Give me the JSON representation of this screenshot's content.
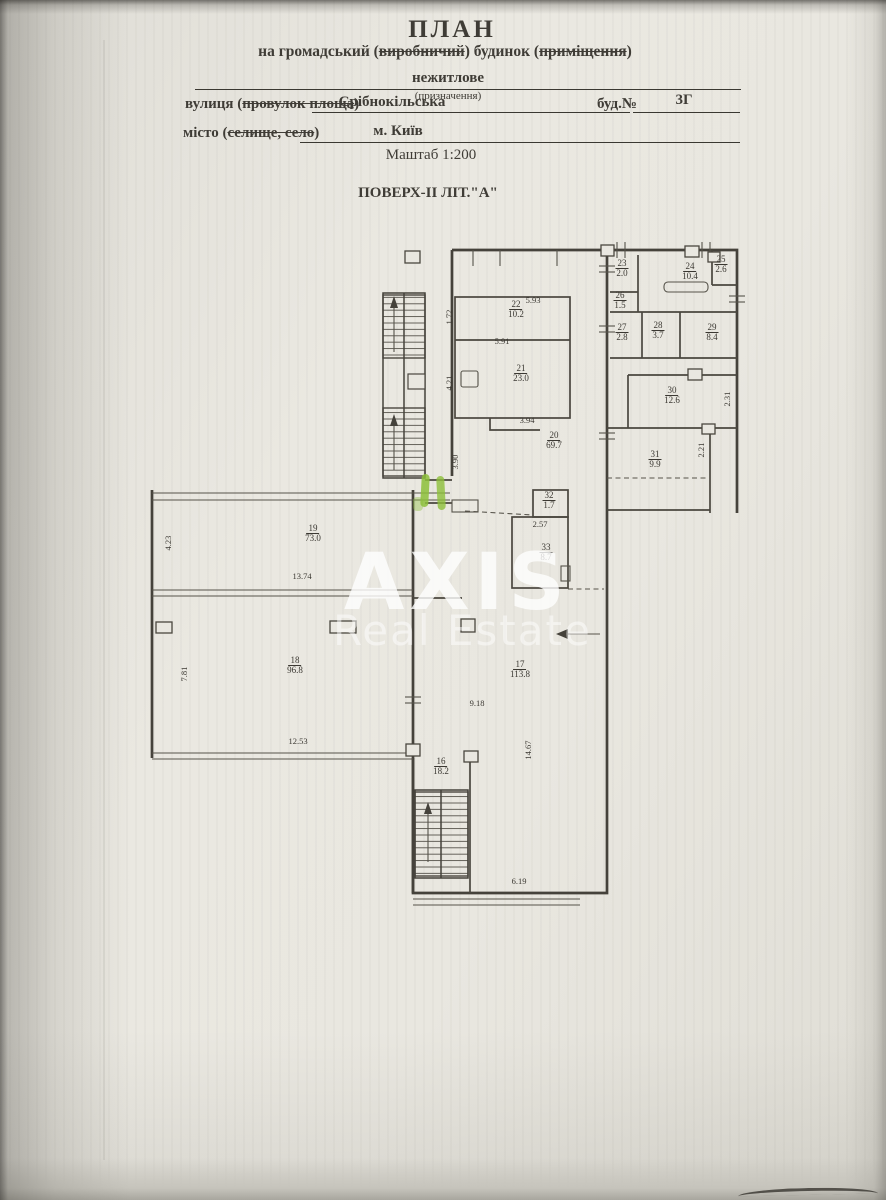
{
  "header": {
    "title": "ПЛАН",
    "subtitle_prefix": "на громадський (",
    "subtitle_struck1": "виробничий",
    "subtitle_mid": ") будинок (",
    "subtitle_struck2": "приміщення",
    "subtitle_suffix": ")",
    "purpose_value": "нежитлове",
    "purpose_caption": "(призначення)",
    "street_prefix": "вулиця (",
    "street_struck": "провулок площа",
    "street_suffix": ")",
    "street_value": "Срібнокільська",
    "building_label": "буд.№",
    "building_value": "3Г",
    "city_prefix": "місто (",
    "city_struck": "селище, село",
    "city_suffix": ")",
    "city_value": "м. Київ",
    "scale": "Маштаб 1:200",
    "floor_title": "ПОВЕРХ-II ЛІТ.\"А\""
  },
  "watermark": {
    "line1": "AXIS",
    "line2": "Real Estate"
  },
  "plan": {
    "rooms": {
      "r16": {
        "number": "16",
        "area": "18.2"
      },
      "r17": {
        "number": "17",
        "area": "113.8"
      },
      "r18": {
        "number": "18",
        "area": "96.8"
      },
      "r19": {
        "number": "19",
        "area": "73.0"
      },
      "r20": {
        "number": "20",
        "area": "69.7"
      },
      "r21": {
        "number": "21",
        "area": "23.0"
      },
      "r22": {
        "number": "22",
        "area": "10.2"
      },
      "r23": {
        "number": "23",
        "area": "2.0"
      },
      "r24": {
        "number": "24",
        "area": "10.4"
      },
      "r25": {
        "number": "25",
        "area": "2.6"
      },
      "r26": {
        "number": "26",
        "area": "1.5"
      },
      "r27": {
        "number": "27",
        "area": "2.8"
      },
      "r28": {
        "number": "28",
        "area": "3.7"
      },
      "r29": {
        "number": "29",
        "area": "8.4"
      },
      "r30": {
        "number": "30",
        "area": "12.6"
      },
      "r31": {
        "number": "31",
        "area": "9.9"
      },
      "r32": {
        "number": "32",
        "area": "1.7"
      },
      "r33": {
        "number": "33",
        "area": "8.7"
      }
    },
    "dims": {
      "w22": "5.93",
      "l22": "1.72",
      "w21": "5.91",
      "l21": "4.21",
      "t20": "3.94",
      "l20": "3.90",
      "w19": "13.74",
      "l19": "4.23",
      "l18": "7.81",
      "w18": "12.53",
      "t33": "2.57",
      "w17": "9.18",
      "r17": "14.67",
      "bottom": "6.19",
      "r30": "2.31",
      "r31": "2.21"
    }
  },
  "colors": {
    "highlight": "#8dbf3b",
    "ink": "#3f3c36",
    "paper": "#e9e7e0"
  }
}
